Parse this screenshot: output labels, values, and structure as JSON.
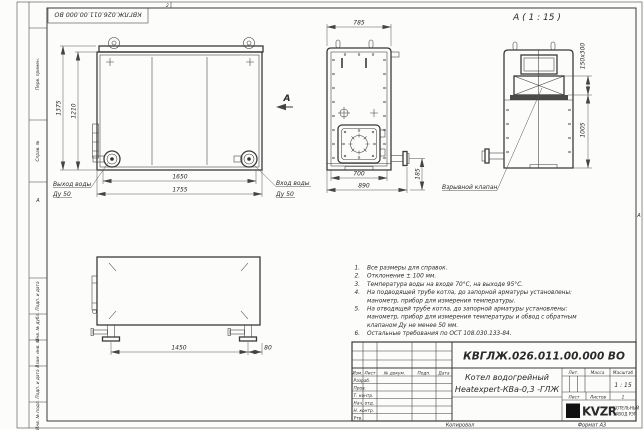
{
  "sheet": {
    "doc_number": "КВГЛЖ.026.011.00.000 ВО",
    "zone_top": "2",
    "zone_left": "А",
    "zone_right": "А",
    "margin_cells": {
      "perv": "Перв. примен.",
      "sprav": "Справ. №",
      "podp1": "Подп. и дата",
      "inv_dubl": "Инв. № дубл.",
      "vzam": "Взам. инв. №",
      "podp2": "Подп. и дата",
      "inv_podl": "Инв. № подл."
    },
    "footer": {
      "copied": "Копировал",
      "format": "Формат А3"
    }
  },
  "front_view": {
    "dim_height_outer": "1375",
    "dim_height_inner": "1210",
    "dim_width_inner": "1650",
    "dim_width_outer": "1755",
    "outlet_line1": "Выход воды",
    "outlet_line2": "Ду 50",
    "inlet_line1": "Вход воды",
    "inlet_line2": "Ду 50",
    "view_arrow": "А"
  },
  "side_view": {
    "dim_width_top": "785",
    "dim_width_inner": "700",
    "dim_width_outer": "890",
    "dim_pipe": "185"
  },
  "detail_view": {
    "title": "А ( 1 : 15 )",
    "dim_valve": "150х300",
    "dim_height": "1005",
    "valve_label": "Взрывной клапан"
  },
  "bottom_view": {
    "dim_span": "1450",
    "dim_offset": "80"
  },
  "notes": {
    "lines": [
      {
        "num": "1.",
        "text": "Все размеры для справок."
      },
      {
        "num": "2.",
        "text": "Отклонение ± 100 мм."
      },
      {
        "num": "3.",
        "text": "Температура воды на входе 70°С, на выходе 95°С."
      },
      {
        "num": "4.",
        "text": "На подводящей трубе котла, до запорной арматуры установлены:"
      },
      {
        "num": "",
        "text": "манометр, прибор для измерения температуры."
      },
      {
        "num": "5.",
        "text": "На отводящей трубе котла, до запорной арматуры установлены:"
      },
      {
        "num": "",
        "text": "манометр, прибор для измерения температуры и обвод с обратным"
      },
      {
        "num": "",
        "text": "клапаном Ду не менее 50 мм."
      },
      {
        "num": "6.",
        "text": "Остальные требования по ОСТ 108.030.133-84."
      }
    ]
  },
  "title_block": {
    "doc_number": "КВГЛЖ.026.011.00.000 ВО",
    "name_line1": "Котел водогрейный",
    "name_line2": "Heatexpert-КВа-0,3 -ГЛЖ",
    "header": {
      "izm": "Изм.",
      "list": "Лист",
      "doc": "№ докум.",
      "podp": "Подп.",
      "data": "Дата"
    },
    "rows": [
      "Разраб.",
      "Пров.",
      "Т. контр.",
      "Нач. отд.",
      "Н. контр.",
      "Утв."
    ],
    "lit": "Лит.",
    "massa": "Масса",
    "scale_label": "Масштаб",
    "scale": "1 : 15",
    "sheet_label": "Лист",
    "sheets_label": "Листов",
    "sheets_value": "1",
    "logo_text": "KVZR",
    "company_line1": "КОТЕЛЬНЫЙ",
    "company_line2": "ЗАВОД РЭП"
  }
}
